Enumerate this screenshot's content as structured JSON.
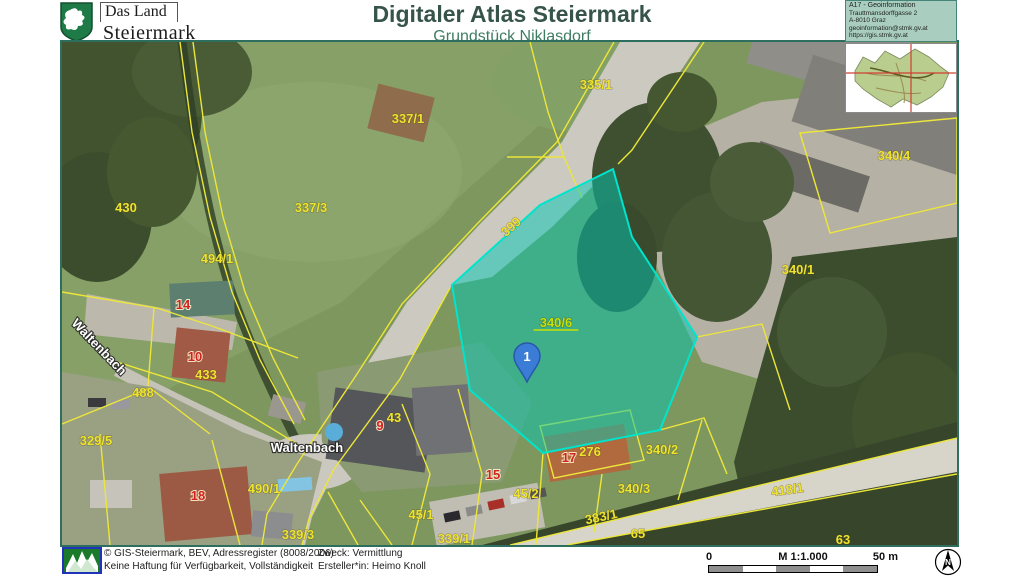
{
  "header": {
    "logo": {
      "line1": "Das Land",
      "line2": "Steiermark"
    },
    "title": "Digitaler Atlas Steiermark",
    "subtitle": "Grundstück Niklasdorf",
    "info_box": {
      "department": "A17 - Geoinformation",
      "address1": "Trauttmansdorffgasse 2",
      "address2": "A-8010 Graz",
      "email": "geoinformation@stmk.gv.at",
      "website": "https://gis.stmk.gv.at"
    }
  },
  "map": {
    "highlight_parcel": {
      "label": "340/6",
      "marker": "1",
      "fill": "#00c8b4",
      "border": "#00e4cc"
    },
    "label_colors": {
      "yellow": "#eee32f",
      "red": "#d32020",
      "white": "#ffffff",
      "green": "#c9e005"
    },
    "labels": [
      {
        "text": "335/1",
        "x": 534,
        "y": 47,
        "color": "yellow"
      },
      {
        "text": "337/1",
        "x": 346,
        "y": 81,
        "color": "yellow"
      },
      {
        "text": "337/3",
        "x": 249,
        "y": 170,
        "color": "yellow"
      },
      {
        "text": "430",
        "x": 64,
        "y": 170,
        "color": "yellow"
      },
      {
        "text": "494/1",
        "x": 155,
        "y": 221,
        "color": "yellow"
      },
      {
        "text": "14",
        "x": 121,
        "y": 267,
        "color": "red"
      },
      {
        "text": "10",
        "x": 133,
        "y": 319,
        "color": "red"
      },
      {
        "text": "433",
        "x": 144,
        "y": 337,
        "color": "yellow",
        "size": 11
      },
      {
        "text": "488",
        "x": 81,
        "y": 355,
        "color": "yellow"
      },
      {
        "text": "Waltenbach",
        "x": 34,
        "y": 308,
        "color": "white",
        "rot": 46,
        "size": 15
      },
      {
        "text": "329/5",
        "x": 34,
        "y": 403,
        "color": "yellow"
      },
      {
        "text": "18",
        "x": 136,
        "y": 458,
        "color": "red"
      },
      {
        "text": "490/1",
        "x": 202,
        "y": 451,
        "color": "yellow"
      },
      {
        "text": "339/3",
        "x": 236,
        "y": 497,
        "color": "yellow"
      },
      {
        "text": "Waltenbach",
        "x": 245,
        "y": 410,
        "color": "white",
        "size": 15
      },
      {
        "text": "9",
        "x": 318,
        "y": 388,
        "color": "red"
      },
      {
        "text": "43",
        "x": 332,
        "y": 380,
        "color": "yellow"
      },
      {
        "text": "45/1",
        "x": 359,
        "y": 477,
        "color": "yellow"
      },
      {
        "text": "339/1",
        "x": 392,
        "y": 501,
        "color": "yellow"
      },
      {
        "text": "15",
        "x": 431,
        "y": 437,
        "color": "red"
      },
      {
        "text": "45/2",
        "x": 464,
        "y": 456,
        "color": "yellow"
      },
      {
        "text": "17",
        "x": 507,
        "y": 420,
        "color": "red"
      },
      {
        "text": "276",
        "x": 528,
        "y": 414,
        "color": "yellow"
      },
      {
        "text": "340/2",
        "x": 600,
        "y": 412,
        "color": "yellow"
      },
      {
        "text": "340/3",
        "x": 572,
        "y": 451,
        "color": "yellow"
      },
      {
        "text": "383/1",
        "x": 540,
        "y": 479,
        "color": "yellow",
        "rot": -12
      },
      {
        "text": "65",
        "x": 576,
        "y": 496,
        "color": "yellow"
      },
      {
        "text": "63",
        "x": 781,
        "y": 502,
        "color": "yellow"
      },
      {
        "text": "418/1",
        "x": 726,
        "y": 452,
        "color": "yellow",
        "rot": -8
      },
      {
        "text": "340/4",
        "x": 832,
        "y": 118,
        "color": "yellow"
      },
      {
        "text": "340/1",
        "x": 736,
        "y": 232,
        "color": "yellow"
      },
      {
        "text": "399",
        "x": 452,
        "y": 188,
        "color": "yellow",
        "rot": -42,
        "size": 11
      },
      {
        "text": "340/6",
        "x": 494,
        "y": 285,
        "color": "green",
        "size": 14,
        "underline": true
      }
    ]
  },
  "footer": {
    "copyright1": "© GIS-Steiermark, BEV, Adressregister (8008/2006)",
    "copyright2": "Keine Haftung für Verfügbarkeit, Vollständigkeit",
    "purpose": "Zweck: Vermittlung",
    "creator": "Ersteller*in: Heimo Knoll",
    "scale": {
      "start": "0",
      "ratio": "M 1:1.000",
      "end": "50 m"
    },
    "north_label": "N"
  }
}
